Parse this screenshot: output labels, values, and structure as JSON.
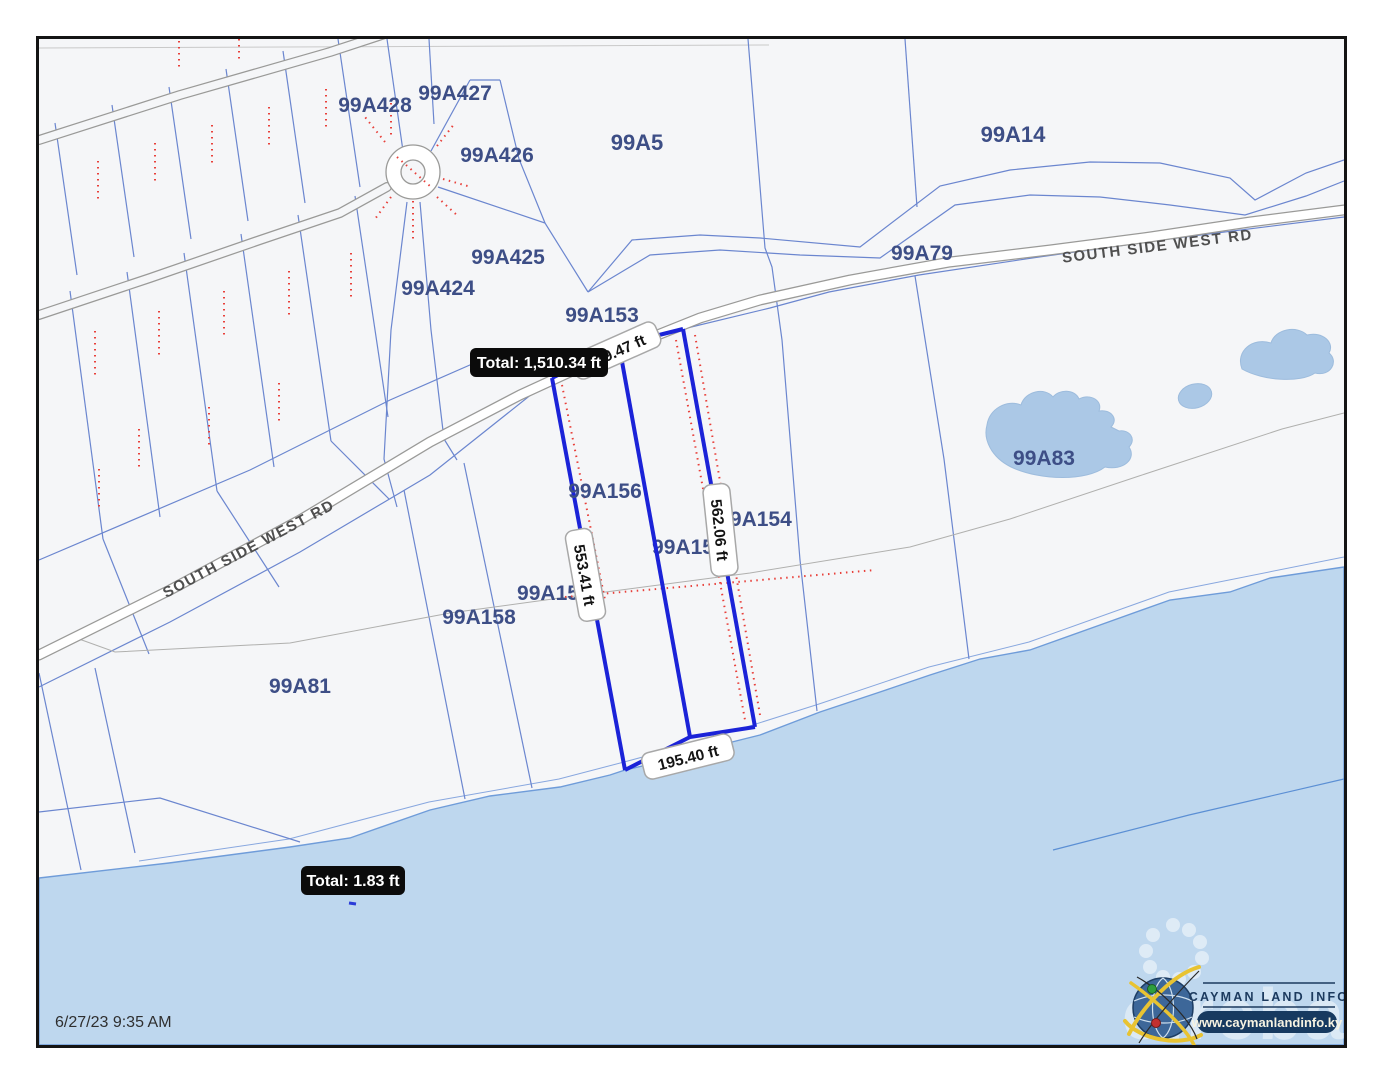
{
  "map": {
    "timestamp": "6/27/23 9:35 AM",
    "road_label": "SOUTH SIDE WEST RD",
    "parcels": {
      "a428": "99A428",
      "a427": "99A427",
      "a426": "99A426",
      "a5": "99A5",
      "a14": "99A14",
      "a79": "99A79",
      "a425": "99A425",
      "a424": "99A424",
      "a153": "99A153",
      "a83": "99A83",
      "a156": "99A156",
      "a154": "99A154",
      "a155_partial": "99A15",
      "a157_partial": "99A15",
      "a158": "99A158",
      "a81": "99A81"
    }
  },
  "measurements": {
    "perimeter_total": "Total: 1,510.34 ft",
    "segment_top": "199.47 ft",
    "segment_left": "553.41 ft",
    "segment_right": "562.06 ft",
    "segment_bottom": "195.40 ft",
    "second_total": "Total: 1.83 ft"
  },
  "branding": {
    "logo_title": "CAYMAN LAND INFO",
    "logo_url": "www.caymanlandinfo.ky",
    "watermark": "cireba"
  },
  "colors": {
    "water": "#bed7ee",
    "parcel_line": "#6b86cf",
    "selection_blue": "#1b23d8",
    "measure_red": "#e8403a",
    "label_navy": "#3d4e86",
    "road_gray": "#9a9a98"
  }
}
